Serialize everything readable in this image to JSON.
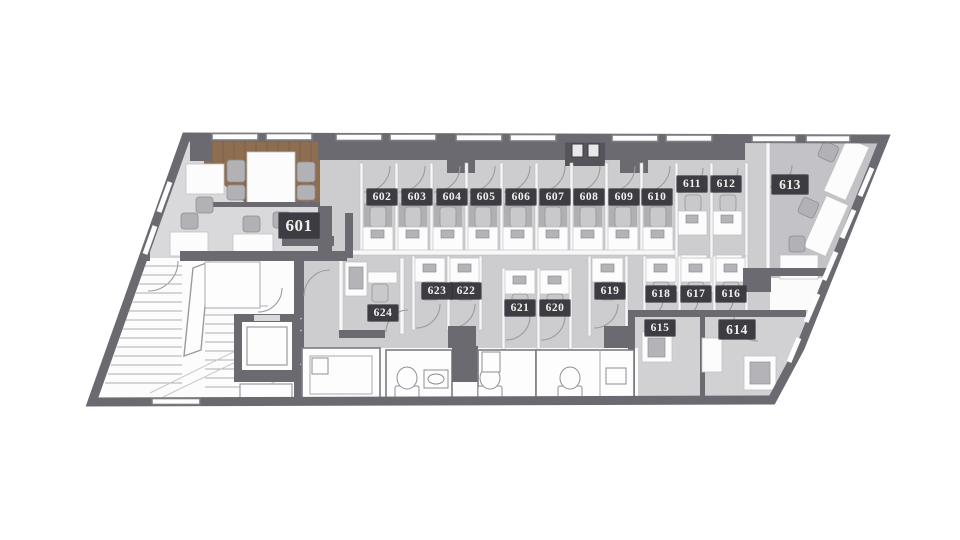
{
  "plan": {
    "name": "Office floor plan — 6th floor",
    "rooms": [
      {
        "number": "601"
      },
      {
        "number": "602"
      },
      {
        "number": "603"
      },
      {
        "number": "604"
      },
      {
        "number": "605"
      },
      {
        "number": "606"
      },
      {
        "number": "607"
      },
      {
        "number": "608"
      },
      {
        "number": "609"
      },
      {
        "number": "610"
      },
      {
        "number": "611"
      },
      {
        "number": "612"
      },
      {
        "number": "613"
      },
      {
        "number": "614"
      },
      {
        "number": "615"
      },
      {
        "number": "616"
      },
      {
        "number": "617"
      },
      {
        "number": "618"
      },
      {
        "number": "619"
      },
      {
        "number": "620"
      },
      {
        "number": "621"
      },
      {
        "number": "622"
      },
      {
        "number": "623"
      },
      {
        "number": "624"
      }
    ],
    "colors": {
      "background": "#ffffff",
      "wall": "#6b6a70",
      "badge_bg": "#3d3c43",
      "badge_text": "#f3f1ec",
      "floor_open_office": "#d9d9db",
      "floor_booth_zone": "#cdcdd0",
      "floor_room_613": "#c3c3c7",
      "floor_rooms_614_615": "#d1d1d4",
      "floor_core_white": "#fcfcfc",
      "wood_lounge": "#8e6e51"
    },
    "fixture_icons": [
      "stairs-icon",
      "elevator-icon",
      "toilet-icon",
      "sink-icon",
      "desk-icon",
      "office-chair-icon",
      "meeting-table-icon",
      "door-swing-icon",
      "window-icon",
      "equipment-icon"
    ]
  }
}
